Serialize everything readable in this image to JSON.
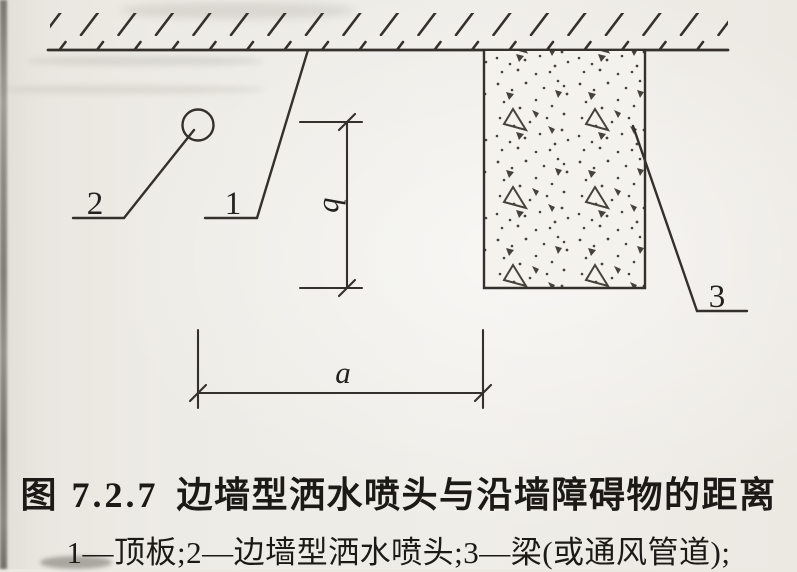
{
  "figure": {
    "caption": {
      "prefix": "图 7.2.7",
      "title": "边墙型洒水喷头与沿墙障碍物的距离"
    },
    "legend": "1—顶板;2—边墙型洒水喷头;3—梁(或通风管道);",
    "callouts": {
      "ceiling": "1",
      "sprinkler": "2",
      "beam": "3"
    },
    "dimensions": {
      "horizontal": "a",
      "vertical": "b"
    },
    "colors": {
      "paper": "#edebe5",
      "line": "#34312c",
      "ink": "#1c1a16"
    }
  }
}
